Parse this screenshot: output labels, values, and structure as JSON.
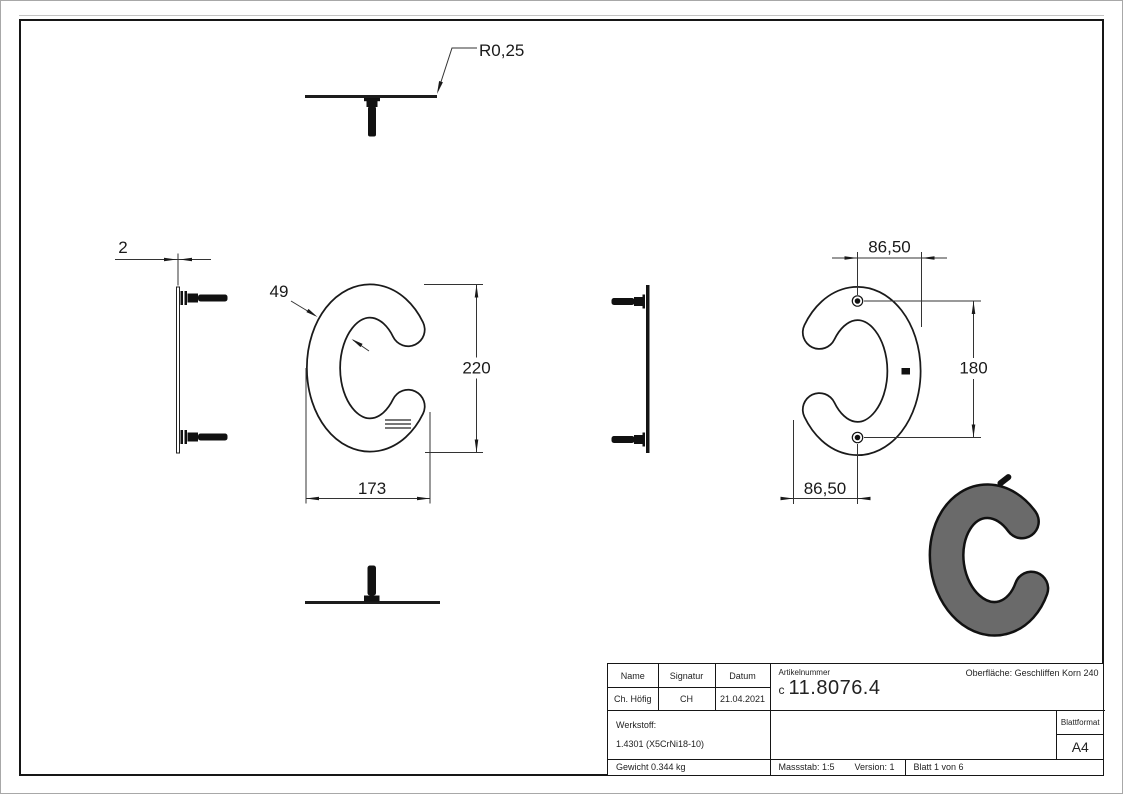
{
  "dims": {
    "radius": "R0,25",
    "thickness": "2",
    "stroke_width": "49",
    "height": "220",
    "width": "173",
    "hole_offset_top": "86,50",
    "hole_spacing": "180",
    "hole_offset_bottom": "86,50"
  },
  "title_block": {
    "header": {
      "name": "Name",
      "signatur": "Signatur",
      "datum": "Datum"
    },
    "values": {
      "name": "Ch. Höfig",
      "signatur": "CH",
      "datum": "21.04.2021"
    },
    "artikelnummer_label": "Artikelnummer",
    "artikelnummer_prefix": "c",
    "artikelnummer": "11.8076.4",
    "oberflaeche": "Oberfläche:  Geschliffen Korn 240",
    "werkstoff_label": "Werkstoff:",
    "werkstoff_value": "1.4301 (X5CrNi18-10)",
    "blattformat_label": "Blattformat",
    "blattformat_value": "A4",
    "gewicht": "Gewicht 0.344 kg",
    "massstab": "Massstab: 1:5",
    "version": "Version: 1",
    "blatt": "Blatt 1 von 6"
  },
  "colors": {
    "line": "#1a1a1a",
    "letter_fill_iso": "#6a6a6a",
    "background": "#ffffff"
  }
}
